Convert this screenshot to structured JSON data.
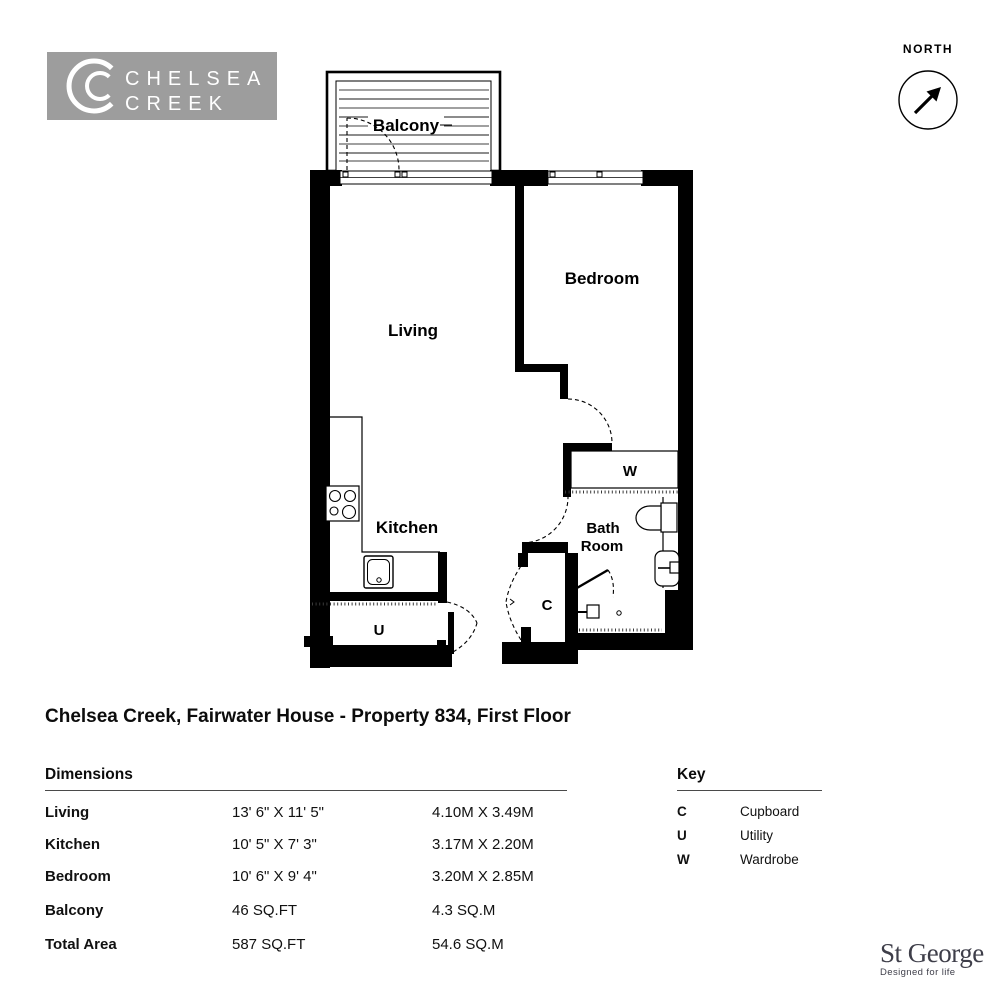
{
  "logo": {
    "brand_line1": "CHELSEA",
    "brand_line2": "CREEK",
    "bg_color": "#9d9d9d"
  },
  "north": {
    "label": "NORTH"
  },
  "plan": {
    "rooms": {
      "balcony": "Balcony",
      "living": "Living",
      "bedroom": "Bedroom",
      "kitchen": "Kitchen",
      "bathroom_line1": "Bath",
      "bathroom_line2": "Room",
      "wardrobe": "W",
      "utility": "U",
      "cupboard": "C"
    }
  },
  "title": "Chelsea Creek, Fairwater House - Property 834, First Floor",
  "dimensions": {
    "heading": "Dimensions",
    "rows": [
      {
        "label": "Living",
        "imperial": "13' 6\" X 11' 5\"",
        "metric": "4.10M X 3.49M"
      },
      {
        "label": "Kitchen",
        "imperial": "10' 5\" X 7' 3\"",
        "metric": "3.17M X 2.20M"
      },
      {
        "label": "Bedroom",
        "imperial": "10' 6\" X 9' 4\"",
        "metric": "3.20M X 2.85M"
      },
      {
        "label": "Balcony",
        "imperial": "46 SQ.FT",
        "metric": "4.3 SQ.M"
      },
      {
        "label": "Total Area",
        "imperial": "587 SQ.FT",
        "metric": "54.6 SQ.M"
      }
    ]
  },
  "key": {
    "heading": "Key",
    "rows": [
      {
        "symbol": "C",
        "label": "Cupboard"
      },
      {
        "symbol": "U",
        "label": "Utility"
      },
      {
        "symbol": "W",
        "label": "Wardrobe"
      }
    ]
  },
  "footer": {
    "brand": "St George",
    "tagline": "Designed for life",
    "color": "#3e3e49"
  }
}
